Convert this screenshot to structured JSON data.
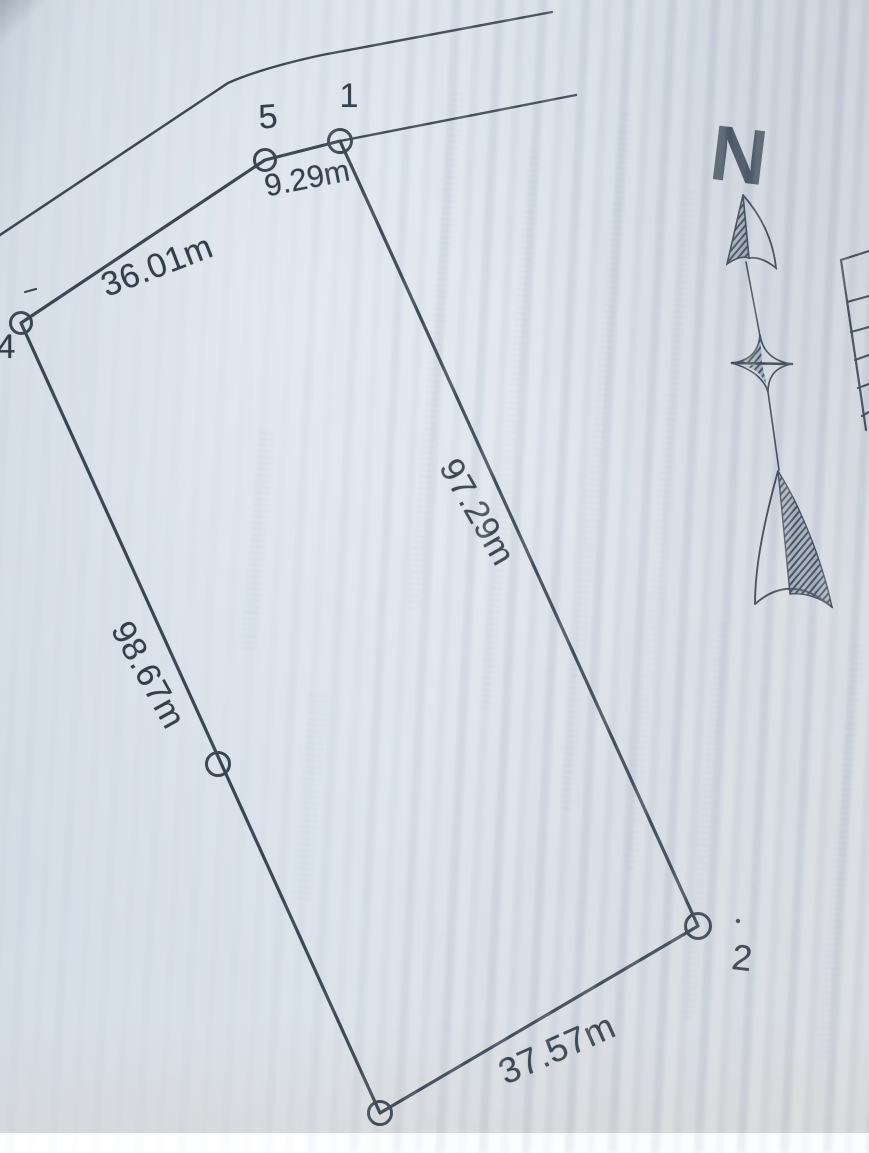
{
  "colors": {
    "ink": "#37424e",
    "paper": "#d6dee8"
  },
  "survey_plot": {
    "north_label": "N",
    "vertex_labels": [
      {
        "id": "5"
      },
      {
        "id": "1"
      },
      {
        "id": "4"
      },
      {
        "id": "2"
      }
    ],
    "measurements": [
      {
        "edge": "5-1",
        "value": "9.29m"
      },
      {
        "edge": "4-5",
        "value": "36.01m"
      },
      {
        "edge": "1-2",
        "value": "97.29m"
      },
      {
        "edge": "4-3",
        "value": "98.67m"
      },
      {
        "edge": "3-2",
        "value": "37.57m"
      }
    ]
  }
}
